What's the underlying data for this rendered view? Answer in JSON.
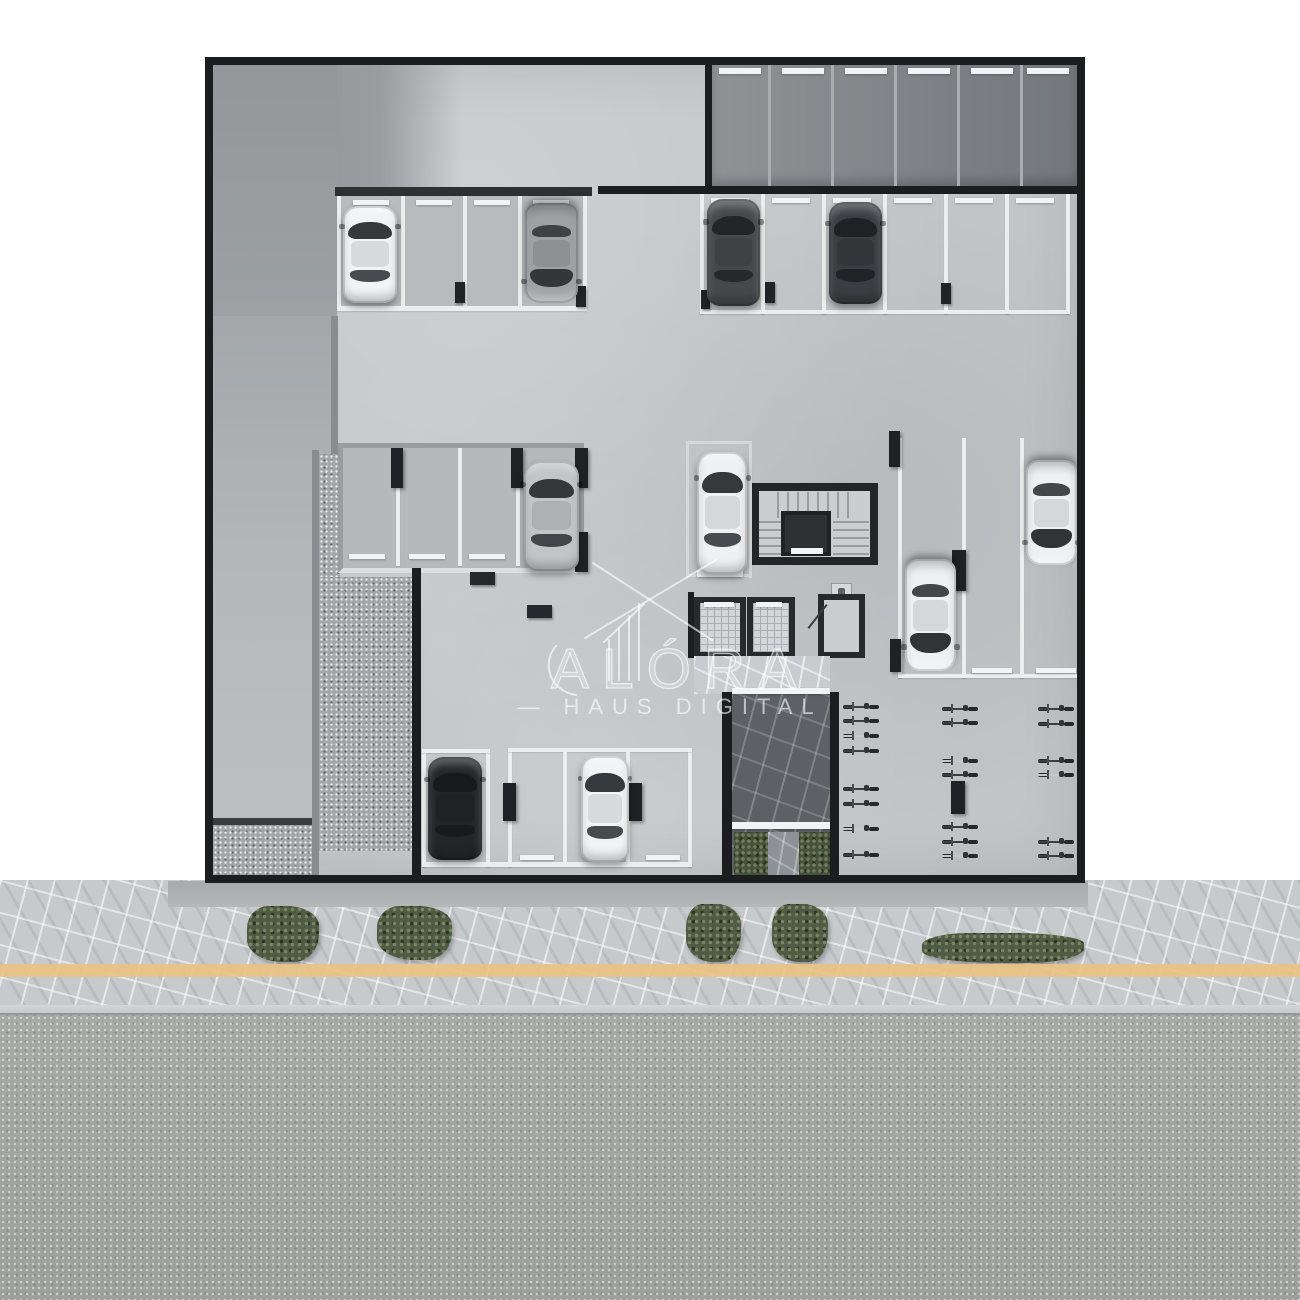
{
  "watermark": {
    "brand": "ALÓRA",
    "dash": "—",
    "tagline": "HAUS DIGITAL"
  },
  "scene_summary": {
    "type": "top-down 3D floor plan render, parking garage level with street",
    "cars_visible": 10,
    "bicycles_visible": 21,
    "elevators": 2,
    "stairwells": 1,
    "hedges": 5
  },
  "palette": {
    "paper": "#ffffff",
    "wall": "#1b1d1f",
    "floor": "#c2c4c6",
    "line-white": "#eceeee",
    "gravel": "#a3a6a8",
    "flag-light": "#c7cacd",
    "flag-dark": "#5d6165",
    "green": "#4f5b44",
    "yellow": "#e8c383",
    "road": "#a6a9a4",
    "curb": "#cfd1d2",
    "pillar": "#1f2124",
    "core-wall": "#232527",
    "tread": "#9a9da0",
    "hatch": "#d3d6d8",
    "hatch-line": "#a9adb0"
  },
  "scene": {
    "underlays": [
      {
        "t": "zoneB",
        "x": 213,
        "y": 65,
        "w": 124,
        "h": 251
      },
      {
        "t": "zoneA",
        "x": 337,
        "y": 65,
        "w": 125,
        "h": 122
      },
      {
        "t": "ramp",
        "x": 213,
        "y": 316,
        "w": 118,
        "h": 504
      },
      {
        "t": "rampline",
        "x": 213,
        "y": 818,
        "w": 118,
        "h": 7
      },
      {
        "t": "gravel",
        "x": 213,
        "y": 825,
        "w": 100,
        "h": 50
      },
      {
        "t": "graywall",
        "x": 331,
        "y": 316,
        "w": 7,
        "h": 138
      },
      {
        "t": "graywall",
        "x": 312,
        "y": 450,
        "w": 7,
        "h": 426
      },
      {
        "t": "gravel",
        "x": 319,
        "y": 454,
        "w": 21,
        "h": 123
      },
      {
        "t": "gravel",
        "x": 319,
        "y": 577,
        "w": 93,
        "h": 274
      }
    ],
    "markings": [
      {
        "t": "wallseg",
        "x": 412,
        "y": 568,
        "w": 9,
        "h": 308
      },
      {
        "t": "wallseg",
        "x": 598,
        "y": 186,
        "w": 487,
        "h": 8
      },
      {
        "t": "wallseg",
        "x": 705,
        "y": 61,
        "w": 7,
        "h": 133
      },
      {
        "t": "wallbar",
        "x": 335,
        "y": 187,
        "w": 257,
        "h": 9
      },
      {
        "t": "wallseg",
        "x": 722,
        "y": 692,
        "w": 10,
        "h": 186
      },
      {
        "t": "wallseg",
        "x": 830,
        "y": 692,
        "w": 9,
        "h": 186
      },
      {
        "t": "wallseg",
        "x": 688,
        "y": 592,
        "w": 6,
        "h": 66
      },
      {
        "t": "encline",
        "x": 768,
        "y": 65,
        "w": 3,
        "h": 121
      },
      {
        "t": "encline",
        "x": 831,
        "y": 65,
        "w": 3,
        "h": 121
      },
      {
        "t": "encline",
        "x": 894,
        "y": 65,
        "w": 3,
        "h": 121
      },
      {
        "t": "encline",
        "x": 957,
        "y": 65,
        "w": 3,
        "h": 121
      },
      {
        "t": "encline",
        "x": 1020,
        "y": 65,
        "w": 3,
        "h": 121
      },
      {
        "t": "line",
        "x": 337,
        "y": 196,
        "w": 4,
        "h": 112
      },
      {
        "t": "line",
        "x": 583,
        "y": 196,
        "w": 4,
        "h": 112
      },
      {
        "t": "line",
        "x": 401,
        "y": 196,
        "w": 4,
        "h": 110
      },
      {
        "t": "line",
        "x": 463,
        "y": 196,
        "w": 4,
        "h": 110
      },
      {
        "t": "line",
        "x": 518,
        "y": 196,
        "w": 4,
        "h": 110
      },
      {
        "t": "line",
        "x": 337,
        "y": 306,
        "w": 250,
        "h": 5
      },
      {
        "t": "line",
        "x": 700,
        "y": 194,
        "w": 4,
        "h": 120
      },
      {
        "t": "line",
        "x": 761,
        "y": 194,
        "w": 4,
        "h": 120
      },
      {
        "t": "line",
        "x": 822,
        "y": 194,
        "w": 4,
        "h": 120
      },
      {
        "t": "line",
        "x": 883,
        "y": 194,
        "w": 4,
        "h": 120
      },
      {
        "t": "line",
        "x": 944,
        "y": 194,
        "w": 4,
        "h": 120
      },
      {
        "t": "line",
        "x": 1005,
        "y": 194,
        "w": 4,
        "h": 120
      },
      {
        "t": "line",
        "x": 1066,
        "y": 194,
        "w": 4,
        "h": 120
      },
      {
        "t": "line",
        "x": 700,
        "y": 310,
        "w": 370,
        "h": 4
      },
      {
        "t": "line",
        "x": 396,
        "y": 448,
        "w": 4,
        "h": 118
      },
      {
        "t": "line",
        "x": 458,
        "y": 448,
        "w": 4,
        "h": 118
      },
      {
        "t": "line",
        "x": 516,
        "y": 448,
        "w": 4,
        "h": 118
      },
      {
        "t": "lineSoft",
        "x": 686,
        "y": 441,
        "w": 3,
        "h": 137
      },
      {
        "t": "lineSoft",
        "x": 749,
        "y": 441,
        "w": 3,
        "h": 137
      },
      {
        "t": "lineSoft",
        "x": 686,
        "y": 441,
        "w": 66,
        "h": 3
      },
      {
        "t": "lineSoft",
        "x": 686,
        "y": 574,
        "w": 66,
        "h": 3
      },
      {
        "t": "line",
        "x": 898,
        "y": 438,
        "w": 4,
        "h": 240
      },
      {
        "t": "line",
        "x": 962,
        "y": 438,
        "w": 4,
        "h": 240
      },
      {
        "t": "line",
        "x": 1020,
        "y": 438,
        "w": 4,
        "h": 240
      },
      {
        "t": "line",
        "x": 898,
        "y": 674,
        "w": 184,
        "h": 4
      },
      {
        "t": "line",
        "x": 422,
        "y": 749,
        "w": 4,
        "h": 118
      },
      {
        "t": "line",
        "x": 486,
        "y": 749,
        "w": 4,
        "h": 118
      },
      {
        "t": "line",
        "x": 422,
        "y": 749,
        "w": 68,
        "h": 4
      },
      {
        "t": "line",
        "x": 508,
        "y": 748,
        "w": 4,
        "h": 119
      },
      {
        "t": "line",
        "x": 688,
        "y": 748,
        "w": 4,
        "h": 119
      },
      {
        "t": "line",
        "x": 508,
        "y": 748,
        "w": 184,
        "h": 4
      },
      {
        "t": "line",
        "x": 563,
        "y": 752,
        "w": 4,
        "h": 111
      },
      {
        "t": "line",
        "x": 626,
        "y": 752,
        "w": 4,
        "h": 111
      },
      {
        "t": "line",
        "x": 422,
        "y": 862,
        "w": 270,
        "h": 5
      },
      {
        "t": "wbar",
        "x": 719,
        "y": 68,
        "w": 42,
        "h": 6
      },
      {
        "t": "wbar",
        "x": 782,
        "y": 68,
        "w": 42,
        "h": 6
      },
      {
        "t": "wbar",
        "x": 845,
        "y": 68,
        "w": 42,
        "h": 6
      },
      {
        "t": "wbar",
        "x": 908,
        "y": 68,
        "w": 42,
        "h": 6
      },
      {
        "t": "wbar",
        "x": 971,
        "y": 68,
        "w": 42,
        "h": 6
      },
      {
        "t": "wbar",
        "x": 1027,
        "y": 68,
        "w": 42,
        "h": 6
      },
      {
        "t": "wbar",
        "x": 353,
        "y": 200,
        "w": 36,
        "h": 5
      },
      {
        "t": "wbar",
        "x": 416,
        "y": 200,
        "w": 36,
        "h": 5
      },
      {
        "t": "wbar",
        "x": 474,
        "y": 200,
        "w": 36,
        "h": 5
      },
      {
        "t": "wbar",
        "x": 533,
        "y": 200,
        "w": 36,
        "h": 5
      },
      {
        "t": "wbar",
        "x": 711,
        "y": 198,
        "w": 38,
        "h": 5
      },
      {
        "t": "wbar",
        "x": 772,
        "y": 198,
        "w": 38,
        "h": 5
      },
      {
        "t": "wbar",
        "x": 833,
        "y": 198,
        "w": 38,
        "h": 5
      },
      {
        "t": "wbar",
        "x": 894,
        "y": 198,
        "w": 38,
        "h": 5
      },
      {
        "t": "wbar",
        "x": 955,
        "y": 198,
        "w": 38,
        "h": 5
      },
      {
        "t": "wbar",
        "x": 1016,
        "y": 198,
        "w": 38,
        "h": 5
      },
      {
        "t": "wbar",
        "x": 349,
        "y": 554,
        "w": 36,
        "h": 5
      },
      {
        "t": "wbar",
        "x": 409,
        "y": 554,
        "w": 36,
        "h": 5
      },
      {
        "t": "wbar",
        "x": 469,
        "y": 554,
        "w": 36,
        "h": 5
      },
      {
        "t": "wbar",
        "x": 530,
        "y": 554,
        "w": 36,
        "h": 5
      },
      {
        "t": "wbar",
        "x": 972,
        "y": 668,
        "w": 40,
        "h": 5
      },
      {
        "t": "wbar",
        "x": 1036,
        "y": 668,
        "w": 40,
        "h": 5
      },
      {
        "t": "wbar",
        "x": 520,
        "y": 855,
        "w": 34,
        "h": 5
      },
      {
        "t": "wbar",
        "x": 646,
        "y": 855,
        "w": 34,
        "h": 5
      },
      {
        "t": "wbar",
        "x": 704,
        "y": 602,
        "w": 30,
        "h": 5
      },
      {
        "t": "wbar",
        "x": 756,
        "y": 602,
        "w": 26,
        "h": 5
      },
      {
        "t": "wbar",
        "x": 697,
        "y": 570,
        "w": 46,
        "h": 7
      },
      {
        "t": "wbar",
        "x": 732,
        "y": 688,
        "w": 98,
        "h": 6
      },
      {
        "t": "wbar",
        "x": 732,
        "y": 822,
        "w": 98,
        "h": 7
      },
      {
        "t": "wbar",
        "x": 791,
        "y": 548,
        "w": 32,
        "h": 6
      },
      {
        "t": "pillar",
        "x": 391,
        "y": 448,
        "w": 12,
        "h": 40
      },
      {
        "t": "pillar",
        "x": 511,
        "y": 448,
        "w": 12,
        "h": 40
      },
      {
        "t": "pillar",
        "x": 575,
        "y": 448,
        "w": 13,
        "h": 40
      },
      {
        "t": "pillar",
        "x": 575,
        "y": 532,
        "w": 13,
        "h": 40
      },
      {
        "t": "pillar",
        "x": 889,
        "y": 431,
        "w": 11,
        "h": 36
      },
      {
        "t": "pillar",
        "x": 952,
        "y": 550,
        "w": 14,
        "h": 41
      },
      {
        "t": "pillar",
        "x": 890,
        "y": 639,
        "w": 11,
        "h": 33
      },
      {
        "t": "pillar",
        "x": 503,
        "y": 783,
        "w": 13,
        "h": 38
      },
      {
        "t": "pillar",
        "x": 629,
        "y": 783,
        "w": 13,
        "h": 38
      },
      {
        "t": "pillar",
        "x": 951,
        "y": 781,
        "w": 14,
        "h": 33
      },
      {
        "t": "bollard",
        "x": 455,
        "y": 282,
        "w": 10,
        "h": 21
      },
      {
        "t": "bollard",
        "x": 576,
        "y": 286,
        "w": 10,
        "h": 21
      },
      {
        "t": "bollard",
        "x": 701,
        "y": 290,
        "w": 9,
        "h": 19
      },
      {
        "t": "bollard",
        "x": 765,
        "y": 282,
        "w": 10,
        "h": 21
      },
      {
        "t": "bollard",
        "x": 941,
        "y": 283,
        "w": 10,
        "h": 21
      },
      {
        "t": "stop",
        "x": 470,
        "y": 572,
        "w": 25,
        "h": 13
      },
      {
        "t": "stop",
        "x": 527,
        "y": 605,
        "w": 25,
        "h": 13
      },
      {
        "t": "planter",
        "x": 734,
        "y": 832,
        "w": 34,
        "h": 46
      },
      {
        "t": "planter",
        "x": 799,
        "y": 832,
        "w": 31,
        "h": 46
      },
      {
        "t": "pathmid",
        "x": 768,
        "y": 832,
        "w": 31,
        "h": 48
      }
    ],
    "cars": [
      {
        "name": "white car",
        "x": 343,
        "y": 206,
        "w": 54,
        "h": 97,
        "body": "#f2f3f4",
        "glass": "#35393c",
        "front": "up"
      },
      {
        "name": "gray car",
        "x": 525,
        "y": 203,
        "w": 53,
        "h": 100,
        "body": "#9fa2a5",
        "glass": "#33373a",
        "front": "down"
      },
      {
        "name": "dark suv",
        "x": 707,
        "y": 199,
        "w": 53,
        "h": 107,
        "body": "#46484b",
        "glass": "#232527",
        "front": "up"
      },
      {
        "name": "dark sedan",
        "x": 829,
        "y": 202,
        "w": 53,
        "h": 102,
        "body": "#3a3d41",
        "glass": "#1f2124",
        "front": "up"
      },
      {
        "name": "silver car",
        "x": 524,
        "y": 461,
        "w": 55,
        "h": 110,
        "body": "#c2c4c6",
        "glass": "#34383b",
        "front": "up"
      },
      {
        "name": "white suv",
        "x": 697,
        "y": 452,
        "w": 50,
        "h": 122,
        "body": "#eff0f1",
        "glass": "#35393c",
        "front": "up"
      },
      {
        "name": "white car",
        "x": 905,
        "y": 559,
        "w": 51,
        "h": 112,
        "body": "#eef0f1",
        "glass": "#313437",
        "front": "down"
      },
      {
        "name": "white car",
        "x": 1026,
        "y": 460,
        "w": 51,
        "h": 105,
        "body": "#eef0f1",
        "glass": "#313437",
        "front": "down"
      },
      {
        "name": "black pickup",
        "x": 428,
        "y": 757,
        "w": 54,
        "h": 103,
        "body": "#232528",
        "glass": "#17191b",
        "front": "up"
      },
      {
        "name": "white car",
        "x": 581,
        "y": 756,
        "w": 48,
        "h": 106,
        "body": "#f2f3f4",
        "glass": "#35393c",
        "front": "up"
      }
    ],
    "bikes": {
      "columns": [
        {
          "x": 843,
          "rows": [
            702,
            716,
            731,
            746,
            784,
            799,
            824,
            850
          ]
        },
        {
          "x": 942,
          "rows": [
            704,
            718,
            756,
            770,
            822,
            837,
            851
          ]
        },
        {
          "x": 1038,
          "rows": [
            704,
            719,
            756,
            770,
            837,
            851
          ]
        }
      ]
    },
    "hedges": [
      {
        "x": 247,
        "y": 906,
        "w": 72,
        "h": 56
      },
      {
        "x": 377,
        "y": 906,
        "w": 75,
        "h": 54
      },
      {
        "x": 686,
        "y": 904,
        "w": 55,
        "h": 58
      },
      {
        "x": 772,
        "y": 904,
        "w": 56,
        "h": 58
      },
      {
        "x": 922,
        "y": 933,
        "w": 162,
        "h": 30
      }
    ]
  }
}
